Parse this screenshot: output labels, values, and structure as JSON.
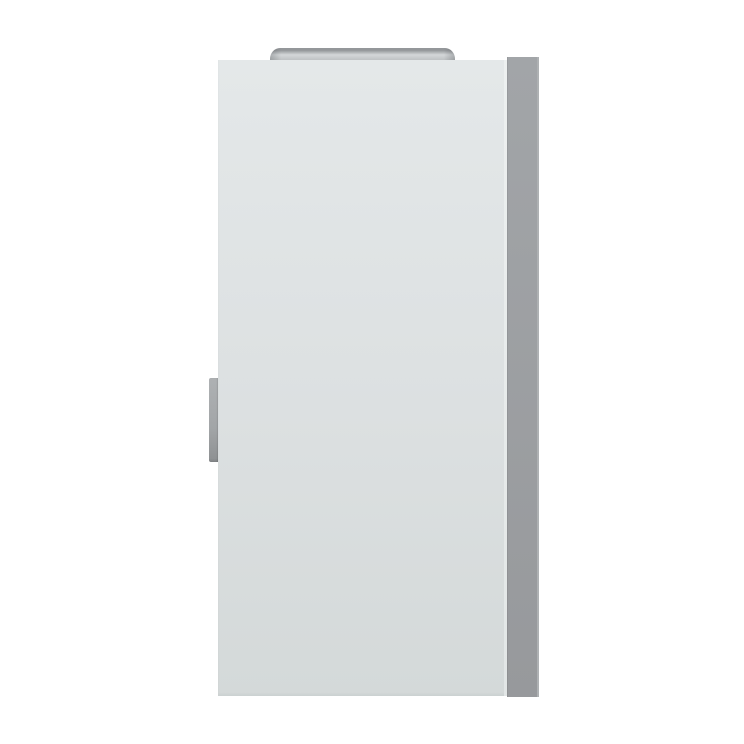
{
  "scene": {
    "description": "Front view 3D product render of a white wall-mounted cabinet appliance with a metallic flue collar on top, a gray right side panel and a small gray handle on the left edge, on a plain white background",
    "objects": [
      {
        "name": "flue-collar",
        "kind": "metallic cylinder cap"
      },
      {
        "name": "appliance-front-panel",
        "kind": "light gray front face"
      },
      {
        "name": "appliance-side-panel",
        "kind": "medium gray right side"
      },
      {
        "name": "door-handle",
        "kind": "small gray handle"
      }
    ]
  },
  "colors": {
    "background": "#ffffff",
    "front_top": "#e4e8e9",
    "front_mid": "#dce0e1",
    "front_bottom": "#d4d9d9",
    "front_highlight": "#edf0f0",
    "front_highlight_b": "#e2e6e6",
    "side_top": "#a2a5a8",
    "side_bottom": "#97999c",
    "side_edge": "#aeb1b3",
    "handle_top": "#aeb1b3",
    "handle_mid": "#a2a5a7",
    "handle_bottom": "#8f9294",
    "handle_shadow": "#7e8183",
    "flue_rim": "#94979a",
    "flue_light": "#d4d7d9",
    "flue_mid": "#c2c5c7",
    "flue_dark": "#a9acaf"
  }
}
